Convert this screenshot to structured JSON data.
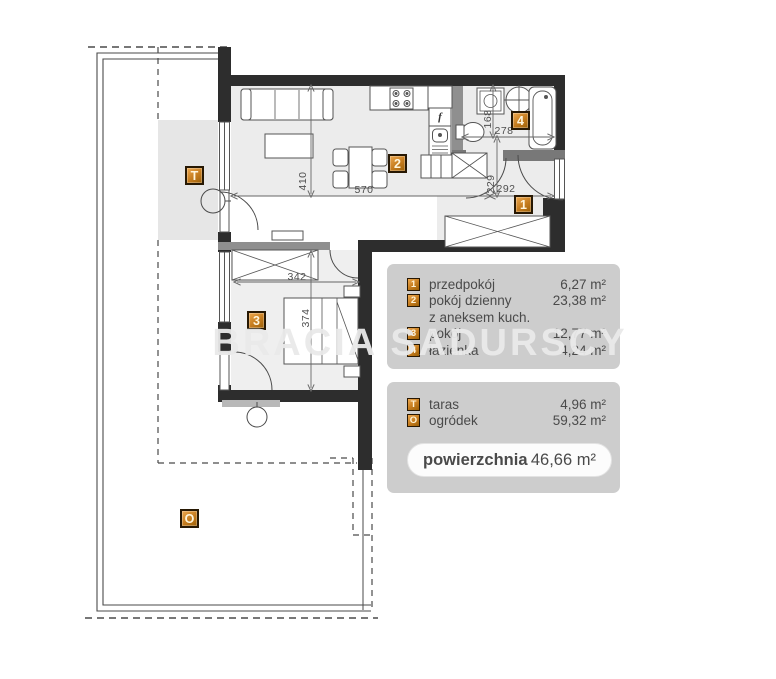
{
  "watermark": {
    "text": "BRACIA SADURSCY"
  },
  "plan": {
    "room_labels": [
      {
        "id": "1"
      },
      {
        "id": "2"
      },
      {
        "id": "3"
      },
      {
        "id": "4"
      },
      {
        "id": "T"
      },
      {
        "id": "O"
      }
    ],
    "dimensions": [
      {
        "text": "570"
      },
      {
        "text": "410"
      },
      {
        "text": "342"
      },
      {
        "text": "374"
      },
      {
        "text": "292"
      },
      {
        "text": "229"
      },
      {
        "text": "278"
      },
      {
        "text": "168"
      }
    ],
    "symbols": [
      {
        "glyph": "f"
      }
    ]
  },
  "legend": {
    "rooms": [
      {
        "badge": "1",
        "name": "przedpokój",
        "area": "6,27 m²"
      },
      {
        "badge": "2",
        "name": "pokój dzienny",
        "name2": "z aneksem kuch.",
        "area": "23,38 m²"
      },
      {
        "badge": "3",
        "name": "pokój",
        "area": "12,77 m²"
      },
      {
        "badge": "4",
        "name": "łazienka",
        "area": "4,24 m²"
      }
    ],
    "outdoor": [
      {
        "badge": "T",
        "name": "taras",
        "area": "4,96 m²"
      },
      {
        "badge": "O",
        "name": "ogródek",
        "area": "59,32 m²"
      }
    ],
    "total": {
      "label": "powierzchnia",
      "value": "46,66 m²"
    }
  },
  "colors": {
    "badge_accent": "#c57c1e",
    "legend_bg": "#cdcdcd",
    "wall": "#2d2d2d"
  }
}
